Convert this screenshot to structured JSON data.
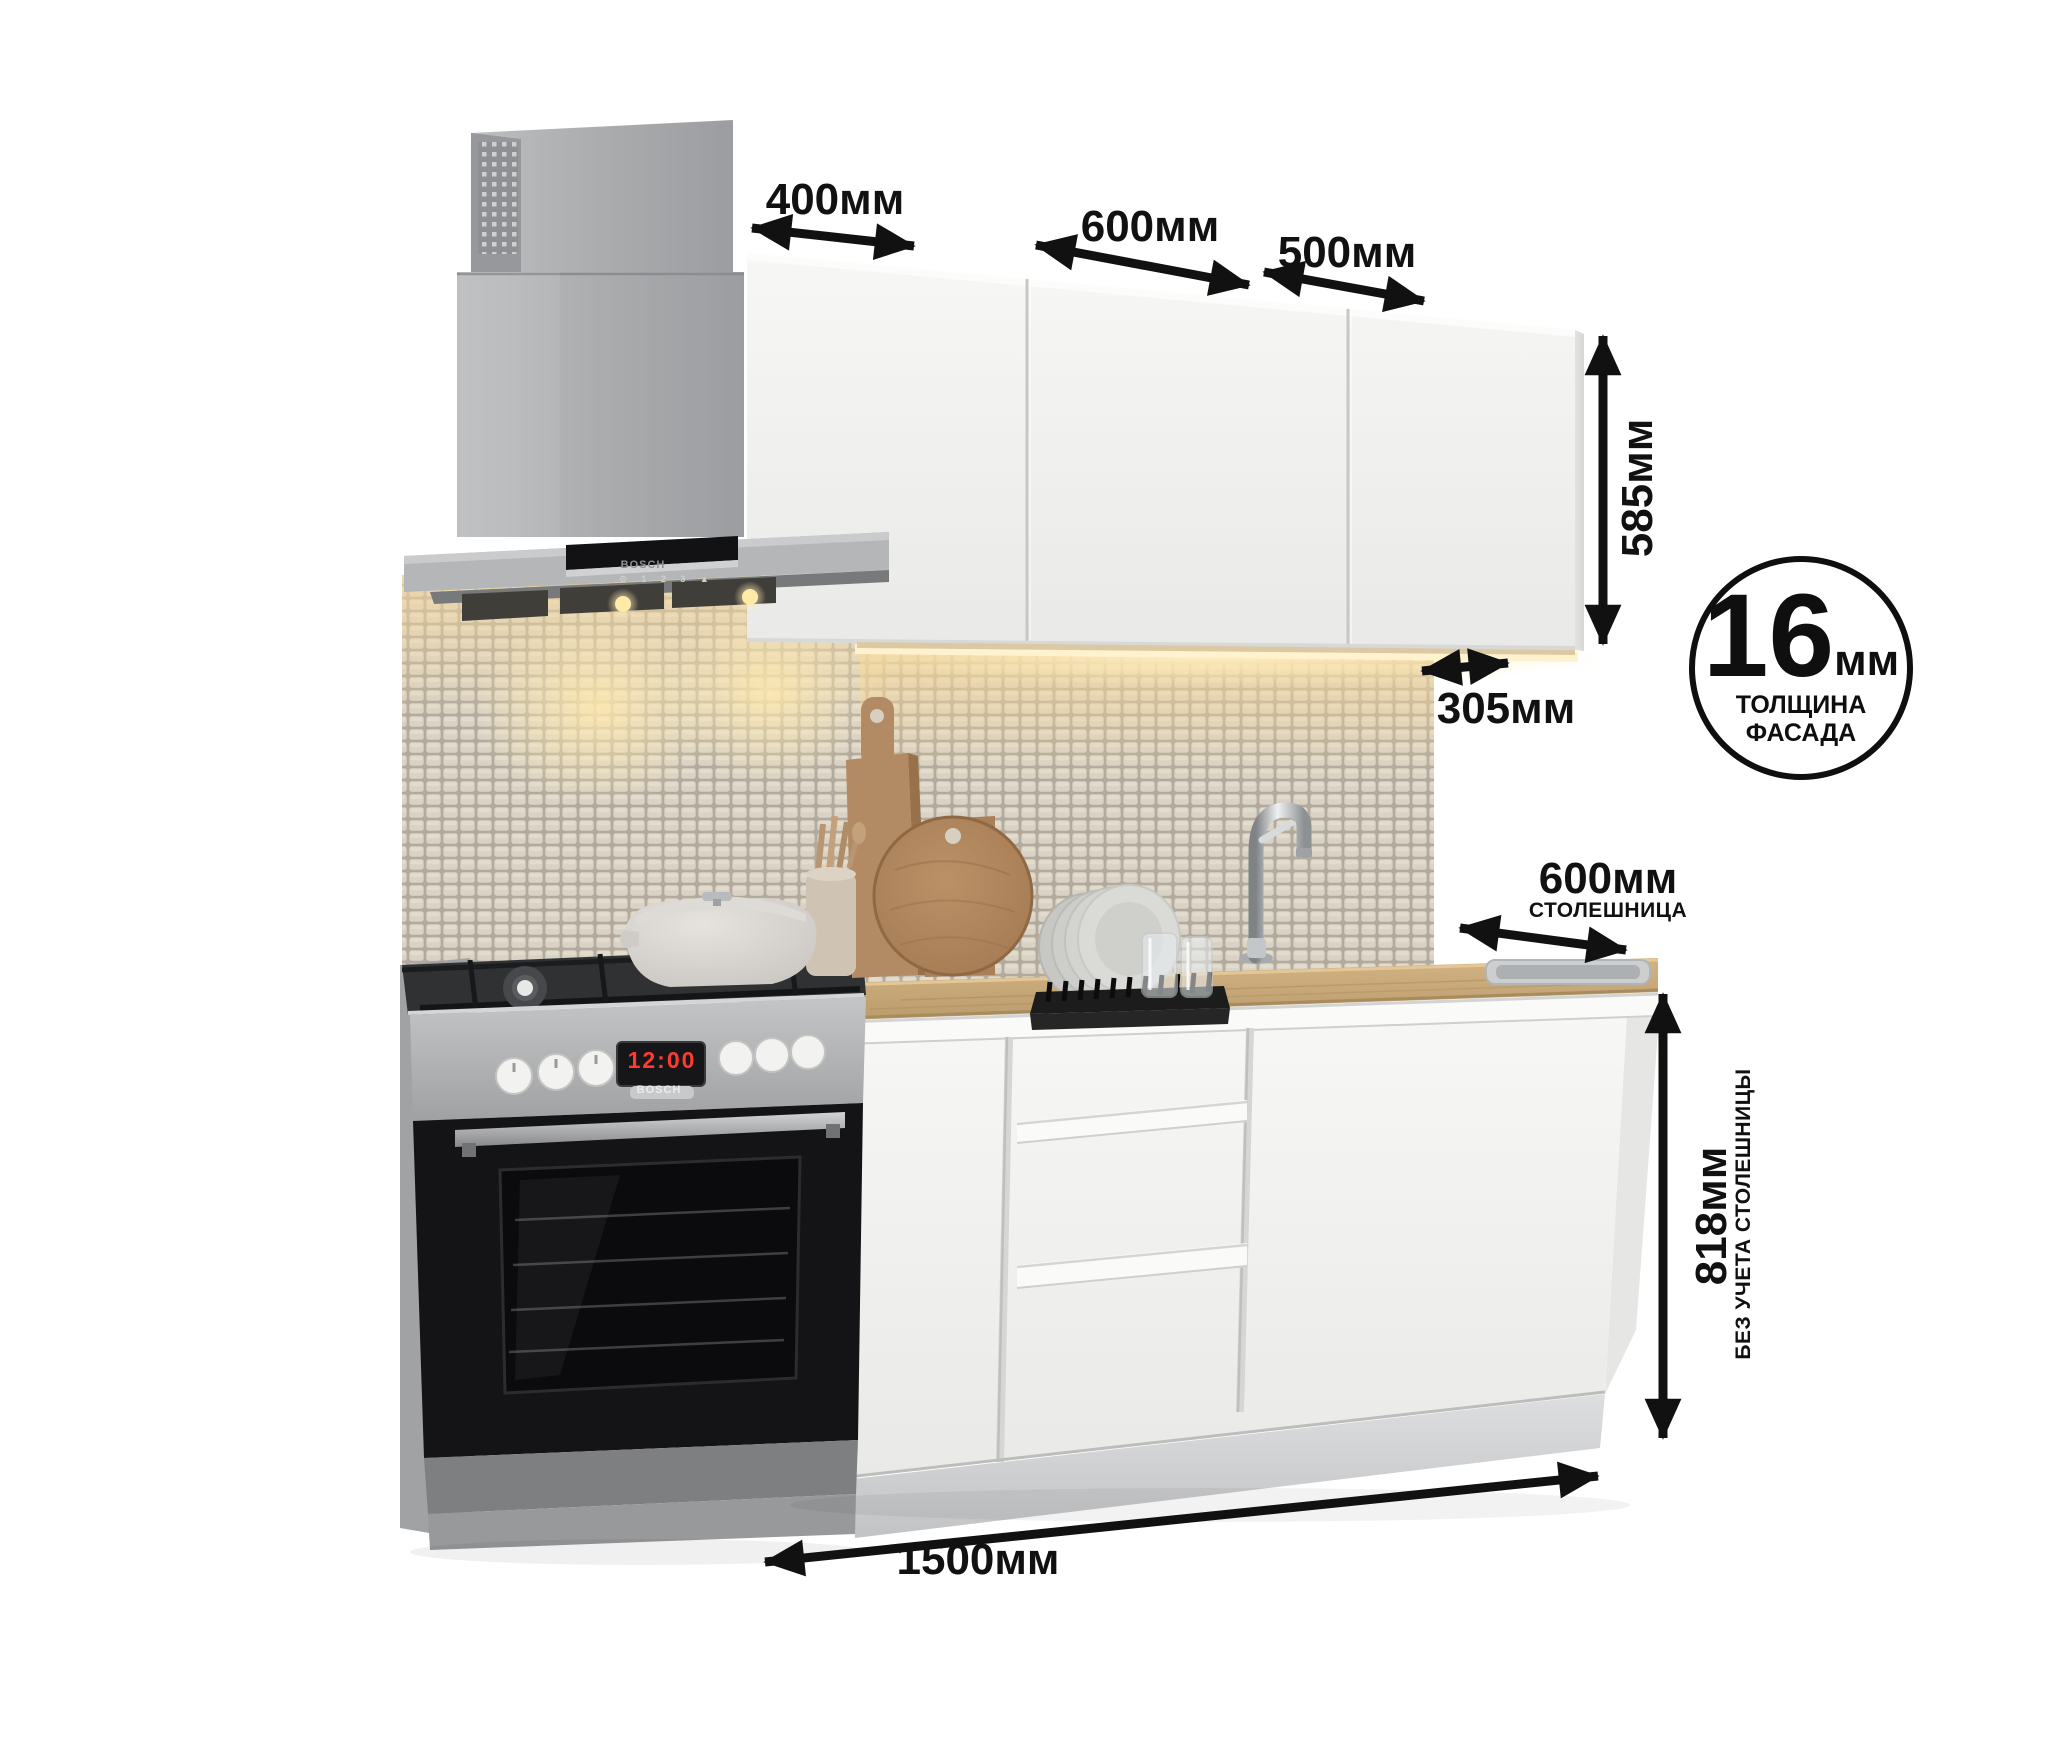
{
  "dimensions": {
    "top_widths": [
      {
        "id": "wall-cabinet-1",
        "label": "400мм"
      },
      {
        "id": "wall-cabinet-2",
        "label": "600мм"
      },
      {
        "id": "wall-cabinet-3",
        "label": "500мм"
      }
    ],
    "wall_cabinet_height": {
      "label": "585мм"
    },
    "wall_cabinet_depth": {
      "label": "305мм"
    },
    "countertop_depth": {
      "label": "600мм",
      "sublabel": "СТОЛЕШНИЦА"
    },
    "base_height": {
      "label": "818мм",
      "sublabel": "БЕЗ УЧЕТА СТОЛЕШНИЦЫ"
    },
    "total_width": {
      "label": "1500мм"
    },
    "facade_badge": {
      "value": "16",
      "unit": "мм",
      "caption1": "ТОЛЩИНА",
      "caption2": "ФАСАДА"
    }
  },
  "appliances": {
    "hood_brand": "BOSCH",
    "stove_brand": "BOSCH",
    "stove_clock": "12:00",
    "hood_keys": "⊙ 1 2 3 ▲"
  },
  "colors": {
    "annotation": "#111111",
    "cabinet_white": "#f2f2f0",
    "countertop_wood": "#c7a878",
    "under_cabinet_glow": "#ffecb4",
    "appliance_steel": "#a9abad"
  }
}
